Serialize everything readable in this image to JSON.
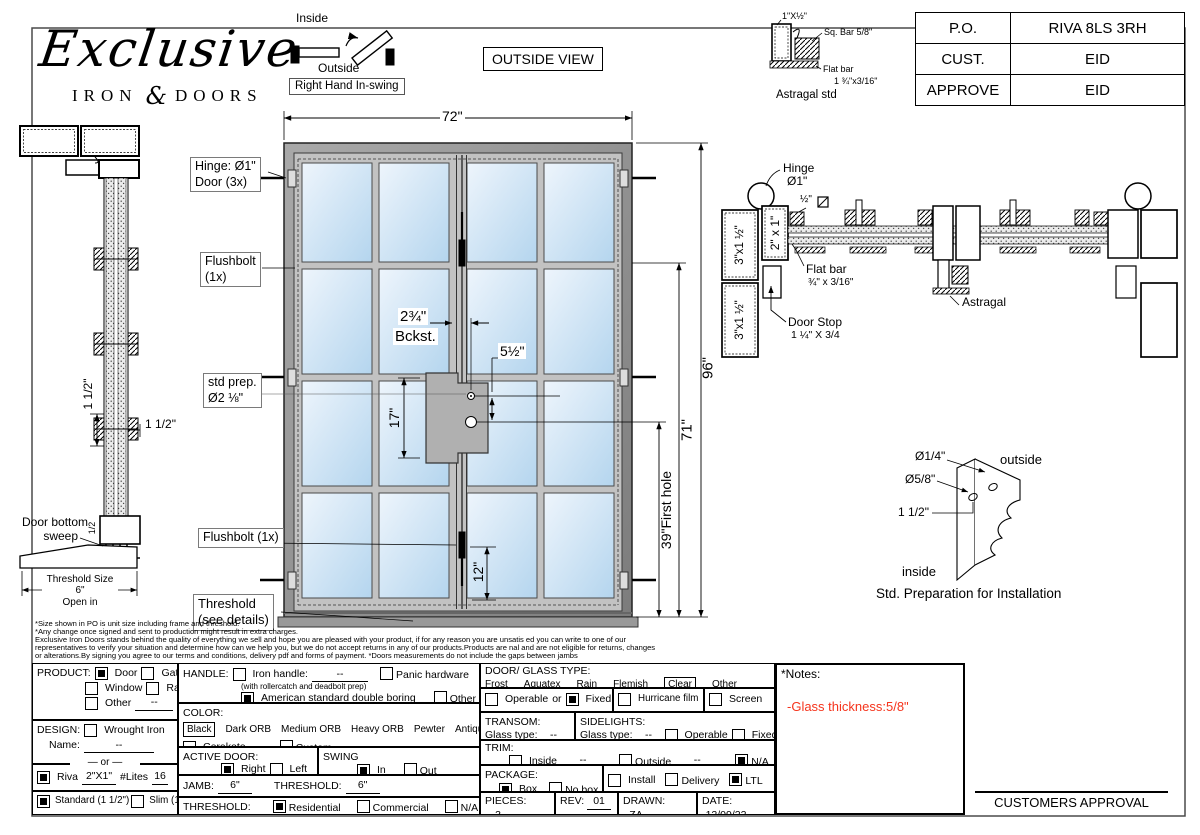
{
  "colors": {
    "note_red": "#f5341c",
    "glass_light": "#ecf4fb",
    "glass_dark": "#b7d7ef",
    "frame": "#8f8f8f"
  },
  "logo": {
    "script": "Exclusive",
    "iron": "IRON",
    "amp": "&",
    "doors": "DOORS"
  },
  "swing_legend": {
    "inside": "Inside",
    "outside": "Outside",
    "tag": "Right Hand In-swing"
  },
  "view_tag": "OUTSIDE VIEW",
  "po_table": {
    "rows": [
      {
        "label": "P.O.",
        "value": "RIVA 8LS 3RH"
      },
      {
        "label": "CUST.",
        "value": "EID"
      },
      {
        "label": "APPROVE",
        "value": "EID"
      }
    ]
  },
  "astragal_std": {
    "dim": "1\"X½\"",
    "sq_bar": "Sq. Bar 5/8\"",
    "flat_bar": "Flat bar",
    "flat_dim": "1 ¾\"x3/16\"",
    "title": "Astragal std"
  },
  "left_section": {
    "dim_v": "1 1/2\"",
    "dim_h": "1 1/2\"",
    "sweep1": "Door bottom",
    "sweep2": "sweep",
    "half": "1/2",
    "th1": "Threshold Size",
    "th2": "6\"",
    "th3": "Open in"
  },
  "elevation": {
    "w": "72\"",
    "h": "96\"",
    "d71": "71\"",
    "d39": "39\"First hole",
    "d17": "17\"",
    "d12": "12\"",
    "d55": "5½\"",
    "bk1": "2¾\"",
    "bk2": "Bckst.",
    "hinge1": "Hinge: Ø1\"",
    "hinge2": "Door (3x)",
    "fb1a": "Flushbolt",
    "fb1b": "(1x)",
    "sp1": "std prep.",
    "sp2": "Ø2 ⅛\"",
    "fb2": "Flushbolt (1x)",
    "th1": "Threshold",
    "th2": "(see details)"
  },
  "right_section": {
    "hinge1": "Hinge",
    "hinge2": "Ø1\"",
    "half_sq": "½\"",
    "tube": "2\" x 1\"",
    "jamb_a": "3\"x1 ½\"",
    "jamb_b": "3\"x1 ½\"",
    "flat1": "Flat bar",
    "flat2": "¾\" x 3/16\"",
    "stop1": "Door Stop",
    "stop2": "1 ¼\" X 3/4",
    "astragal": "Astragal"
  },
  "std_prep": {
    "d14": "Ø1/4\"",
    "d58": "Ø5/8\"",
    "d112": "1 1/2\"",
    "outside": "outside",
    "inside": "inside",
    "title": "Std. Preparation for Installation"
  },
  "disclaimer": {
    "l1": "*Size shown in PO is unit size including frame and threshold.",
    "l2": "*Any change once signed and sent to production might result in extra charges.",
    "l3": "Exclusive Iron Doors stands behind the quality of everything we sell and hope you are pleased with your product, if for any reason you are unsatis ed you can write to one of our",
    "l4": "representatives to verify your situation and determine how can we help you, but we do not accept returns in any of our products.Products are  nal and are not eligible for returns, changes",
    "l5": "or alterations.By signing you agree to our terms and conditions, delivery pdf and forms of payment. *Doors measurements do not include the gaps between jambs"
  },
  "form": {
    "product": {
      "title": "PRODUCT:",
      "door": "Door",
      "gate": "Gate",
      "window": "Window",
      "railling": "Railling",
      "other": "Other",
      "dash": "--"
    },
    "design": {
      "title": "DESIGN:",
      "wrought": "Wrought Iron",
      "name_label": "Name:",
      "dash": "--",
      "or": "or"
    },
    "riva": {
      "label": "Riva",
      "size": "2\"X1\"",
      "lites_label": "#Lites",
      "lites": "16"
    },
    "profile": {
      "standard": "Standard (1 1/2\")",
      "slim": "Slim (1 1/4\")"
    },
    "handle": {
      "title": "HANDLE:",
      "iron": "Iron handle:",
      "dash": "--",
      "note": "(with rollercatch and deadbolt prep)",
      "american": "American standard double boring",
      "panic": "Panic hardware",
      "other": "Other"
    },
    "color": {
      "title": "COLOR:",
      "black": "Black",
      "o1": "Dark ORB",
      "o2": "Medium ORB",
      "o3": "Heavy ORB",
      "o4": "Pewter",
      "o5": "Antique gold",
      "cerakote": "Cerakote",
      "custom": "Custom"
    },
    "active": {
      "title": "ACTIVE DOOR:",
      "right": "Right",
      "left": "Left"
    },
    "swing": {
      "title": "SWING",
      "in": "In",
      "out": "Out"
    },
    "jamb": {
      "title": "JAMB:",
      "value": "6\"",
      "t_title": "THRESHOLD:",
      "t_value": "6\""
    },
    "threshold": {
      "title": "THRESHOLD:",
      "residential": "Residential",
      "commercial": "Commercial",
      "na": "N/A"
    },
    "glass": {
      "title": "DOOR/ GLASS TYPE:",
      "frost": "Frost",
      "aquatex": "Aquatex",
      "rain": "Rain",
      "flemish": "Flemish",
      "clear": "Clear",
      "other": "Other"
    },
    "glass2": {
      "operable": "Operable",
      "or": "or",
      "fixed": "Fixed",
      "hurricane": "Hurricane film",
      "screen": "Screen"
    },
    "transom": {
      "title": "TRANSOM:",
      "glass_label": "Glass type:",
      "dash": "--"
    },
    "sidelights": {
      "title": "SIDELIGHTS:",
      "glass_label": "Glass type:",
      "dash": "--",
      "operable": "Operable",
      "fixed": "Fixed"
    },
    "trim": {
      "title": "TRIM:",
      "inside": "Inside",
      "dash1": "--",
      "outside": "Outside",
      "dash2": "--",
      "na": "N/A"
    },
    "package": {
      "title": "PACKAGE:",
      "box": "Box",
      "nobox": "No box",
      "install": "Install",
      "delivery": "Delivery",
      "ltl": "LTL"
    },
    "meta": {
      "pieces_l": "PIECES:",
      "pieces": "3",
      "rev_l": "REV:",
      "rev": "01",
      "drawn_l": "DRAWN:",
      "drawn": "ZA",
      "date_l": "DATE:",
      "date": "12/09/22"
    }
  },
  "notes": {
    "title": "*Notes:",
    "line": "-Glass thickness:5/8\""
  },
  "approval": "CUSTOMERS APPROVAL"
}
